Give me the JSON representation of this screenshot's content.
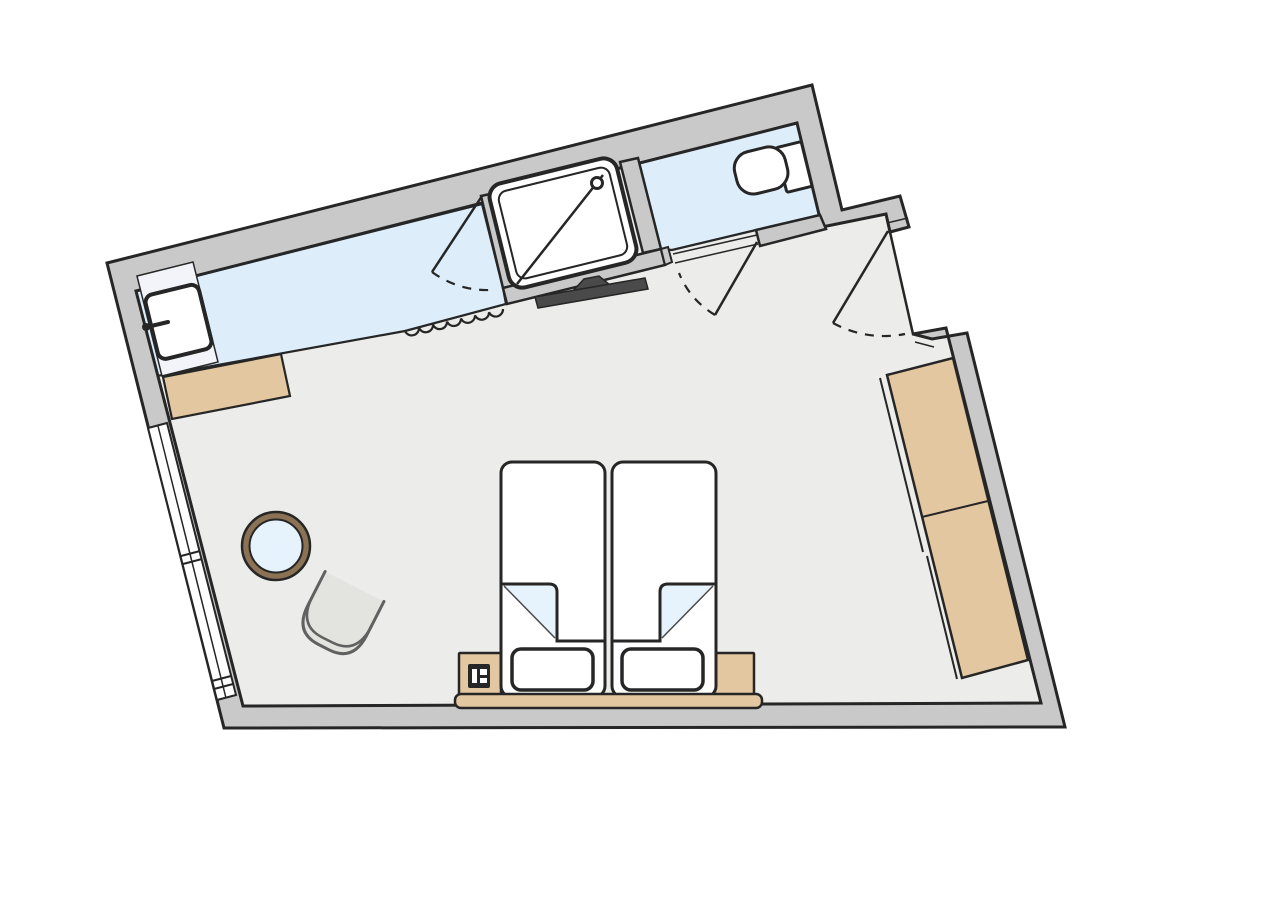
{
  "canvas": {
    "width": 1288,
    "height": 900,
    "background": "#ffffff"
  },
  "palette": {
    "wall": "#c9c9c9",
    "ink": "#262626",
    "floor": "#ececea",
    "bath_blue": "#ddeefa",
    "sheet_blue": "#e7f3fc",
    "tan": "#e3c7a0",
    "vanity_white": "#f3f3fa",
    "fixture_white": "#ffffff",
    "tv_dark": "#4a4a4a",
    "table_rim": "#8b7254",
    "chair_fill": "#e3e4df",
    "chair_stroke": "#616161"
  },
  "shapes": [
    {
      "name": "bedroom-floor",
      "type": "polygon",
      "points": [
        [
          136,
          291
        ],
        [
          797,
          123
        ],
        [
          822,
          227
        ],
        [
          886,
          214
        ],
        [
          890,
          232
        ],
        [
          913,
          334
        ],
        [
          946,
          328
        ],
        [
          1041,
          703
        ],
        [
          243,
          706
        ]
      ],
      "fill": "#ececea",
      "stroke": "#262626",
      "sw": 2.5
    },
    {
      "name": "bathroom-vanity-floor",
      "type": "polygon",
      "points": [
        [
          136,
          291
        ],
        [
          482,
          204
        ],
        [
          503,
          288
        ],
        [
          506,
          304
        ],
        [
          405,
          331
        ],
        [
          157,
          376
        ]
      ],
      "fill": "#ddeefa",
      "stroke": "#262626",
      "sw": 2.2
    },
    {
      "name": "wc-floor",
      "type": "polygon",
      "points": [
        [
          639,
          162
        ],
        [
          797,
          123
        ],
        [
          820,
          215
        ],
        [
          756,
          230
        ],
        [
          672,
          250
        ],
        [
          661,
          249
        ]
      ],
      "fill": "#ddeefa",
      "stroke": "#262626",
      "sw": 2.2
    },
    {
      "name": "perimeter-wall",
      "type": "polygon",
      "points": [
        [
          913,
          334
        ],
        [
          946,
          328
        ],
        [
          1041,
          703
        ],
        [
          243,
          706
        ],
        [
          136,
          291
        ],
        [
          797,
          123
        ],
        [
          822,
          227
        ],
        [
          886,
          214
        ],
        [
          890,
          232
        ],
        [
          909,
          227
        ],
        [
          900,
          196
        ],
        [
          842,
          210
        ],
        [
          812,
          85
        ],
        [
          107,
          263
        ],
        [
          224,
          728
        ],
        [
          1065,
          727
        ],
        [
          967,
          333
        ],
        [
          932,
          339
        ]
      ],
      "fill": "#c9c9c9",
      "stroke": "#262626",
      "sw": 3
    },
    {
      "name": "window-band",
      "type": "polygon",
      "points": [
        [
          148,
          428
        ],
        [
          167,
          423
        ],
        [
          236,
          695
        ],
        [
          217,
          700
        ]
      ],
      "fill": "#ffffff",
      "stroke": "#262626",
      "sw": 2
    },
    {
      "name": "window-center-line",
      "type": "line",
      "x1": 158,
      "y1": 426,
      "x2": 226,
      "y2": 698,
      "stroke": "#262626",
      "sw": 1.5
    },
    {
      "name": "window-divider-tick-1",
      "type": "line",
      "x1": 181,
      "y1": 556,
      "x2": 200,
      "y2": 551,
      "stroke": "#262626",
      "sw": 2
    },
    {
      "name": "window-divider-tick-2",
      "type": "line",
      "x1": 183,
      "y1": 564,
      "x2": 202,
      "y2": 559,
      "stroke": "#262626",
      "sw": 2
    },
    {
      "name": "window-divider-tick-3",
      "type": "line",
      "x1": 212,
      "y1": 681,
      "x2": 231,
      "y2": 676,
      "stroke": "#262626",
      "sw": 2
    },
    {
      "name": "window-divider-tick-4",
      "type": "line",
      "x1": 214,
      "y1": 689,
      "x2": 233,
      "y2": 684,
      "stroke": "#262626",
      "sw": 2
    },
    {
      "name": "luggage-shelf",
      "type": "polygon",
      "points": [
        [
          163,
          377
        ],
        [
          281,
          354
        ],
        [
          290,
          396
        ],
        [
          172,
          419
        ]
      ],
      "fill": "#e3c7a0",
      "stroke": "#262626",
      "sw": 2.2
    },
    {
      "name": "vanity-counter",
      "type": "polygon",
      "points": [
        [
          137,
          276
        ],
        [
          193,
          262
        ],
        [
          218,
          362
        ],
        [
          162,
          376
        ]
      ],
      "fill": "#f3f3fa",
      "stroke": "#262626",
      "sw": 1.5
    },
    {
      "name": "washbasin",
      "type": "rect",
      "x": 151,
      "y": 289,
      "w": 55,
      "h": 66,
      "rx": 8,
      "transform": "rotate(-13.8 178 322)",
      "fill": "#ffffff",
      "stroke": "#262626",
      "sw": 4
    },
    {
      "name": "washbasin-faucet",
      "type": "line",
      "x1": 147,
      "y1": 327,
      "x2": 168,
      "y2": 322,
      "stroke": "#262626",
      "sw": 4,
      "cap": "round"
    },
    {
      "name": "washbasin-faucet-knob",
      "type": "circle",
      "cx": 146,
      "cy": 327,
      "r": 4,
      "fill": "#262626"
    },
    {
      "name": "shower-jamb-left",
      "type": "polygon",
      "points": [
        [
          481,
          196
        ],
        [
          499,
          192
        ],
        [
          521,
          284
        ],
        [
          503,
          288
        ]
      ],
      "fill": "#c9c9c9",
      "stroke": "#262626",
      "sw": 2.5
    },
    {
      "name": "shower-jamb-right",
      "type": "polygon",
      "points": [
        [
          620,
          162
        ],
        [
          638,
          158
        ],
        [
          661,
          249
        ],
        [
          643,
          253
        ]
      ],
      "fill": "#c9c9c9",
      "stroke": "#262626",
      "sw": 2.5
    },
    {
      "name": "tv-wall",
      "type": "polygon",
      "points": [
        [
          503,
          288
        ],
        [
          661,
          249
        ],
        [
          665,
          265
        ],
        [
          507,
          304
        ]
      ],
      "fill": "#c9c9c9",
      "stroke": "#262626",
      "sw": 2.5
    },
    {
      "name": "wc-wall-left-stub",
      "type": "polygon",
      "points": [
        [
          661,
          249
        ],
        [
          668,
          247
        ],
        [
          672,
          262
        ],
        [
          665,
          265
        ]
      ],
      "fill": "#c9c9c9",
      "stroke": "#262626",
      "sw": 2
    },
    {
      "name": "wc-wall-right-stub",
      "type": "polygon",
      "points": [
        [
          756,
          230
        ],
        [
          820,
          215
        ],
        [
          826,
          229
        ],
        [
          760,
          246
        ]
      ],
      "fill": "#c9c9c9",
      "stroke": "#262626",
      "sw": 2.5
    },
    {
      "name": "wc-door-threshold-line-1",
      "type": "line",
      "x1": 673,
      "y1": 254,
      "x2": 757,
      "y2": 235,
      "stroke": "#262626",
      "sw": 1.5
    },
    {
      "name": "wc-door-threshold-line-2",
      "type": "line",
      "x1": 675,
      "y1": 263,
      "x2": 758,
      "y2": 244,
      "stroke": "#262626",
      "sw": 1.5
    },
    {
      "name": "shower-tray",
      "type": "rect",
      "x": 497.5,
      "y": 169.5,
      "w": 131,
      "h": 107,
      "rx": 14,
      "transform": "rotate(-13.8 563 223)",
      "fill": "#ffffff",
      "stroke": "#262626",
      "sw": 4
    },
    {
      "name": "shower-tray-inner",
      "type": "rect",
      "x": 506,
      "y": 178,
      "w": 114,
      "h": 90,
      "rx": 9,
      "transform": "rotate(-13.8 563 223)",
      "fill": "none",
      "stroke": "#262626",
      "sw": 2
    },
    {
      "name": "shower-diagonal",
      "type": "line",
      "x1": 517,
      "y1": 284,
      "x2": 603,
      "y2": 175,
      "stroke": "#262626",
      "sw": 2.5
    },
    {
      "name": "shower-drain",
      "type": "circle",
      "cx": 597,
      "cy": 183,
      "r": 5.5,
      "fill": "#ffffff",
      "stroke": "#262626",
      "sw": 3
    },
    {
      "name": "toilet-tank",
      "type": "rect",
      "x": 781,
      "y": 144,
      "w": 26,
      "h": 46,
      "rx": 2,
      "transform": "rotate(-13.8 794 167)",
      "fill": "#ffffff",
      "stroke": "#262626",
      "sw": 3
    },
    {
      "name": "toilet-bowl",
      "type": "rect",
      "x": 735,
      "y": 149,
      "w": 52,
      "h": 43,
      "rx": 17,
      "transform": "rotate(-13.8 761 170)",
      "fill": "#ffffff",
      "stroke": "#262626",
      "sw": 3
    },
    {
      "name": "tv-mount",
      "type": "polygon",
      "points": [
        [
          572,
          292
        ],
        [
          610,
          285
        ],
        [
          599,
          276
        ],
        [
          584,
          279
        ]
      ],
      "fill": "#4a4a4a",
      "stroke": "#262626",
      "sw": 1.5
    },
    {
      "name": "tv-screen",
      "type": "polygon",
      "points": [
        [
          535,
          297
        ],
        [
          645,
          278
        ],
        [
          648,
          289
        ],
        [
          538,
          308
        ]
      ],
      "fill": "#4a4a4a",
      "stroke": "#262626",
      "sw": 1.5
    },
    {
      "name": "curtain",
      "type": "path",
      "d": "M 405 331 a 7.3 7.3 0 0 0 14 -3.14 a 7.3 7.3 0 0 0 14 -3.14 a 7.3 7.3 0 0 0 14 -3.14 a 7.3 7.3 0 0 0 14 -3.14 a 7.3 7.3 0 0 0 14 -3.14 a 7.3 7.3 0 0 0 14 -3.14 a 7.3 7.3 0 0 0 14 -3.14",
      "fill": "none",
      "stroke": "#262626",
      "sw": 2.2
    },
    {
      "name": "entry-threshold-line-a",
      "type": "line",
      "x1": 887,
      "y1": 223,
      "x2": 908,
      "y2": 218,
      "stroke": "#262626",
      "sw": 1.5
    },
    {
      "name": "entry-threshold-line-b",
      "type": "line",
      "x1": 915,
      "y1": 342,
      "x2": 934,
      "y2": 347,
      "stroke": "#262626",
      "sw": 1.5
    },
    {
      "name": "bathroom-door-leaf",
      "type": "line",
      "x1": 482,
      "y1": 196,
      "x2": 432,
      "y2": 272,
      "stroke": "#262626",
      "sw": 2.5
    },
    {
      "name": "bathroom-door-swing-arc",
      "type": "path",
      "d": "M 432 272 A 92 92 0 0 0 490 290",
      "fill": "none",
      "stroke": "#262626",
      "sw": 2.2,
      "dash": "9 8"
    },
    {
      "name": "wc-door-leaf",
      "type": "line",
      "x1": 757,
      "y1": 242,
      "x2": 715,
      "y2": 315,
      "stroke": "#262626",
      "sw": 2.5
    },
    {
      "name": "wc-door-swing-arc",
      "type": "path",
      "d": "M 715 315 A 85 85 0 0 1 679 273",
      "fill": "none",
      "stroke": "#262626",
      "sw": 2.2,
      "dash": "9 8"
    },
    {
      "name": "entry-door-leaf",
      "type": "line",
      "x1": 888,
      "y1": 231,
      "x2": 833,
      "y2": 323,
      "stroke": "#262626",
      "sw": 2.5
    },
    {
      "name": "entry-door-swing-arc",
      "type": "path",
      "d": "M 833 323 A 107 107 0 0 0 905 334",
      "fill": "none",
      "stroke": "#262626",
      "sw": 2.2,
      "dash": "9 8"
    },
    {
      "name": "wardrobe-door-track-1",
      "type": "line",
      "x1": 880,
      "y1": 378,
      "x2": 923,
      "y2": 552,
      "stroke": "#262626",
      "sw": 2
    },
    {
      "name": "wardrobe-door-track-2",
      "type": "line",
      "x1": 927,
      "y1": 556,
      "x2": 957,
      "y2": 679,
      "stroke": "#262626",
      "sw": 2
    },
    {
      "name": "wardrobe",
      "type": "polygon",
      "points": [
        [
          887,
          375
        ],
        [
          953,
          358
        ],
        [
          1028,
          660
        ],
        [
          962,
          678
        ]
      ],
      "fill": "#e3c7a0",
      "stroke": "#262626",
      "sw": 2.5
    },
    {
      "name": "wardrobe-divider",
      "type": "line",
      "x1": 922,
      "y1": 517,
      "x2": 988,
      "y2": 501,
      "stroke": "#262626",
      "sw": 2
    },
    {
      "name": "nightstand-left",
      "type": "rect",
      "x": 459,
      "y": 653,
      "w": 42,
      "h": 43,
      "rx": 1,
      "fill": "#e3c7a0",
      "stroke": "#262626",
      "sw": 2.5
    },
    {
      "name": "nightstand-right",
      "type": "rect",
      "x": 712,
      "y": 653,
      "w": 42,
      "h": 43,
      "rx": 1,
      "fill": "#e3c7a0",
      "stroke": "#262626",
      "sw": 2.5
    },
    {
      "name": "telephone-body",
      "type": "rect",
      "x": 468,
      "y": 664,
      "w": 22,
      "h": 24,
      "rx": 2,
      "fill": "#262626"
    },
    {
      "name": "telephone-key-1",
      "type": "rect",
      "x": 472,
      "y": 669,
      "w": 5,
      "h": 14,
      "rx": 0,
      "fill": "#ffffff"
    },
    {
      "name": "telephone-key-2",
      "type": "rect",
      "x": 480,
      "y": 669,
      "w": 7,
      "h": 6,
      "rx": 0,
      "fill": "#ffffff"
    },
    {
      "name": "telephone-key-3",
      "type": "rect",
      "x": 480,
      "y": 678,
      "w": 7,
      "h": 5,
      "rx": 0,
      "fill": "#ffffff"
    },
    {
      "name": "bed-mattress-left",
      "type": "rect",
      "x": 501,
      "y": 462,
      "w": 104,
      "h": 235,
      "rx": 11,
      "fill": "#ffffff",
      "stroke": "#262626",
      "sw": 3
    },
    {
      "name": "bed-mattress-right",
      "type": "rect",
      "x": 612,
      "y": 462,
      "w": 104,
      "h": 235,
      "rx": 11,
      "fill": "#ffffff",
      "stroke": "#262626",
      "sw": 3
    },
    {
      "name": "bed-sheet-fold-left",
      "type": "polygon",
      "points": [
        [
          503,
          584
        ],
        [
          557,
          584
        ],
        [
          557,
          640
        ]
      ],
      "fill": "#e7f3fc"
    },
    {
      "name": "bed-sheet-fold-right",
      "type": "polygon",
      "points": [
        [
          714,
          584
        ],
        [
          660,
          584
        ],
        [
          660,
          640
        ]
      ],
      "fill": "#e7f3fc"
    },
    {
      "name": "duvet-edge-left",
      "type": "path",
      "d": "M 501 584 L 549 584 Q 557 584 557 592 L 557 641 L 605 641",
      "fill": "none",
      "stroke": "#262626",
      "sw": 3
    },
    {
      "name": "duvet-edge-right",
      "type": "path",
      "d": "M 716 584 L 668 584 Q 660 584 660 592 L 660 641 L 612 641",
      "fill": "none",
      "stroke": "#262626",
      "sw": 3
    },
    {
      "name": "duvet-fold-diagonal-left",
      "type": "line",
      "x1": 504,
      "y1": 586,
      "x2": 555,
      "y2": 638,
      "stroke": "#4a4a4a",
      "sw": 1.5
    },
    {
      "name": "duvet-fold-diagonal-right",
      "type": "line",
      "x1": 713,
      "y1": 586,
      "x2": 662,
      "y2": 638,
      "stroke": "#4a4a4a",
      "sw": 1.5
    },
    {
      "name": "pillow-left",
      "type": "rect",
      "x": 512,
      "y": 649,
      "w": 81,
      "h": 41,
      "rx": 9,
      "fill": "#ffffff",
      "stroke": "#262626",
      "sw": 3.5
    },
    {
      "name": "pillow-right",
      "type": "rect",
      "x": 622,
      "y": 649,
      "w": 81,
      "h": 41,
      "rx": 9,
      "fill": "#ffffff",
      "stroke": "#262626",
      "sw": 3.5
    },
    {
      "name": "headboard",
      "type": "rect",
      "x": 455,
      "y": 694,
      "w": 307,
      "h": 14,
      "rx": 6,
      "fill": "#e3c7a0",
      "stroke": "#262626",
      "sw": 2.5
    },
    {
      "name": "table-rim",
      "type": "circle",
      "cx": 276,
      "cy": 546,
      "r": 34,
      "fill": "#8b7254",
      "stroke": "#262626",
      "sw": 2.5
    },
    {
      "name": "table-top",
      "type": "circle",
      "cx": 276,
      "cy": 546,
      "r": 26.5,
      "fill": "#e7f3fc",
      "stroke": "#262626",
      "sw": 2
    },
    {
      "name": "chair-shell",
      "type": "path",
      "d": "M -33 -32 L -33 6 Q -33 36 -6 36 L 6 36 Q 33 36 33 6 L 33 -32",
      "transform": "translate(340 615) rotate(27)",
      "fill": "#e3e4df",
      "stroke": "#616161",
      "sw": 3,
      "cap": "round"
    },
    {
      "name": "chair-seat-line",
      "type": "path",
      "d": "M -33 -4 Q -33 28 -6 28 L 6 28 Q 33 28 33 -4",
      "transform": "translate(340 615) rotate(27)",
      "fill": "none",
      "stroke": "#616161",
      "sw": 2.5,
      "cap": "round"
    }
  ]
}
